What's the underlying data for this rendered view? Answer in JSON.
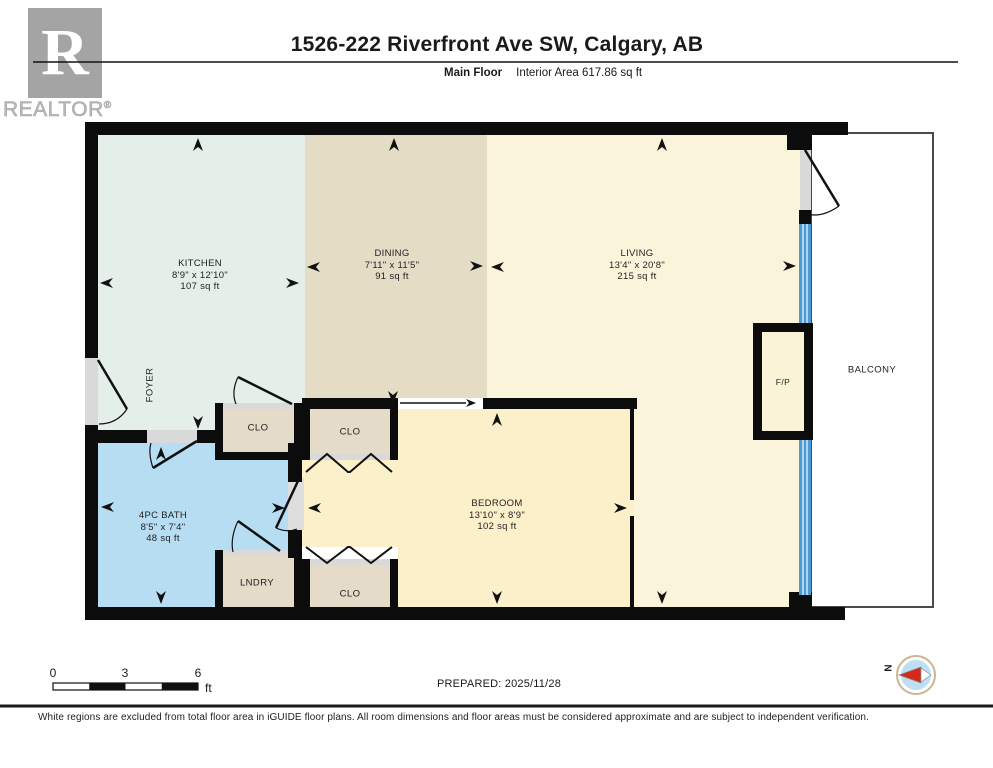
{
  "logo": {
    "letter": "R",
    "brand": "REALTOR",
    "registered": "®"
  },
  "header": {
    "title": "1526-222 Riverfront Ave SW, Calgary, AB",
    "floor_label": "Main Floor",
    "area_label": "Interior Area 617.86 sq ft"
  },
  "rooms": {
    "kitchen": {
      "name": "KITCHEN",
      "dims": "8'9\" x 12'10\"",
      "area": "107 sq ft"
    },
    "dining": {
      "name": "DINING",
      "dims": "7'11\" x 11'5\"",
      "area": "91 sq ft"
    },
    "living": {
      "name": "LIVING",
      "dims": "13'4\" x 20'8\"",
      "area": "215 sq ft"
    },
    "bedroom": {
      "name": "BEDROOM",
      "dims": "13'10\" x 8'9\"",
      "area": "102 sq ft"
    },
    "bath": {
      "name": "4PC BATH",
      "dims": "8'5\" x 7'4\"",
      "area": "48 sq ft"
    },
    "foyer": {
      "name": "FOYER"
    },
    "balcony": {
      "name": "BALCONY"
    },
    "fireplace": {
      "name": "F/P"
    },
    "closet_hall": {
      "name": "CLO"
    },
    "closet_bedroom_top": {
      "name": "CLO"
    },
    "laundry": {
      "name": "LNDRY"
    },
    "closet_bedroom_bottom": {
      "name": "CLO"
    }
  },
  "scale_bar": {
    "ticks": [
      "0",
      "3",
      "6"
    ],
    "unit": "ft"
  },
  "prepared_label": "PREPARED: 2025/11/28",
  "compass": {
    "north_label": "N"
  },
  "footer_note": "White regions are excluded from total floor area in iGUIDE floor plans. All room dimensions and floor areas must be considered approximate and are subject to independent verification.",
  "colors": {
    "wall": "#0c0c0c",
    "kitchen": "#e3efe8",
    "dining": "#e5dcc6",
    "living": "#faf4db",
    "bedroom": "#fcf0ca",
    "bath": "#b7ddf3",
    "closet": "#e4dcc9",
    "glass": "#4a9bd4",
    "balcony_border": "#4a4a4a",
    "compass_red": "#d42a1e"
  }
}
